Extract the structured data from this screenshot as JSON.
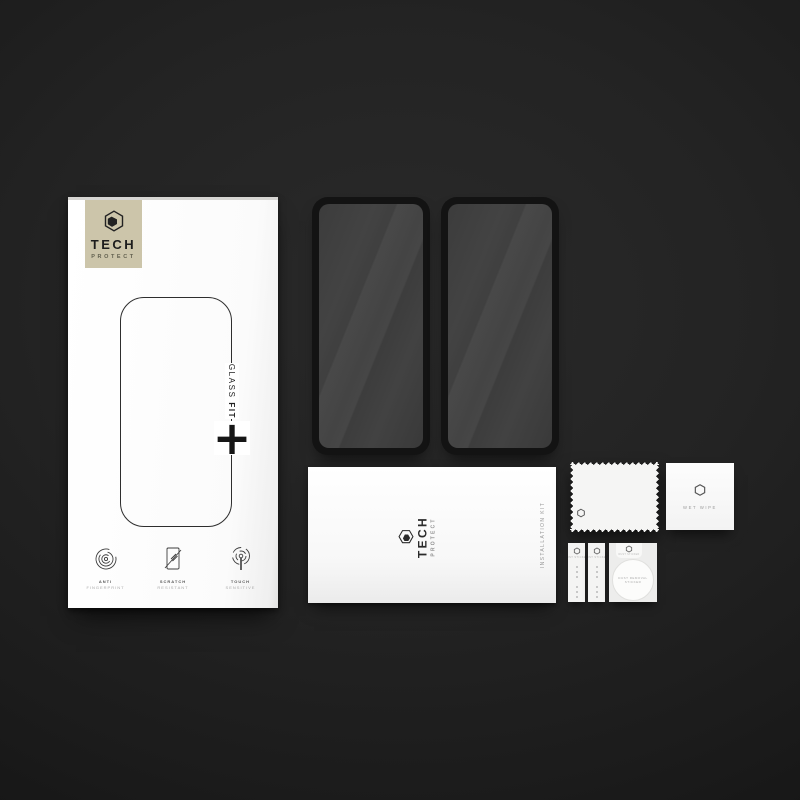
{
  "brand": {
    "word_top": "TECH",
    "word_bottom": "PROTECT"
  },
  "box": {
    "series_label": "GLASS ",
    "series_label_bold": "FIT",
    "plus_mark": "+",
    "features": [
      {
        "icon": "fingerprint-icon",
        "line1": "ANTI",
        "line2": "FINGERPRINT"
      },
      {
        "icon": "scratch-icon",
        "line1": "SCRATCH",
        "line2": "RESISTANT"
      },
      {
        "icon": "touch-icon",
        "line1": "TOUCH",
        "line2": "SENSITIVE"
      }
    ]
  },
  "glass_protectors": {
    "count": "2"
  },
  "pouch": {
    "side_label": "INSTALLATION KIT"
  },
  "wet_wipe": {
    "label": "WET WIPE"
  },
  "dust_strip": {
    "label": "DUST STICKER"
  },
  "round_sticker": {
    "line1": "DUST REMOVAL",
    "line2": "STICKER"
  },
  "icons": {
    "logo": "tech-protect-hexagon",
    "feature_icons": [
      "fingerprint-icon",
      "scratch-icon",
      "touch-icon"
    ]
  },
  "colors": {
    "background": "#232323",
    "badge_beige": "#ccc5aa",
    "glass_tint": "#3e3e3e",
    "ink": "#1c1c1c"
  }
}
